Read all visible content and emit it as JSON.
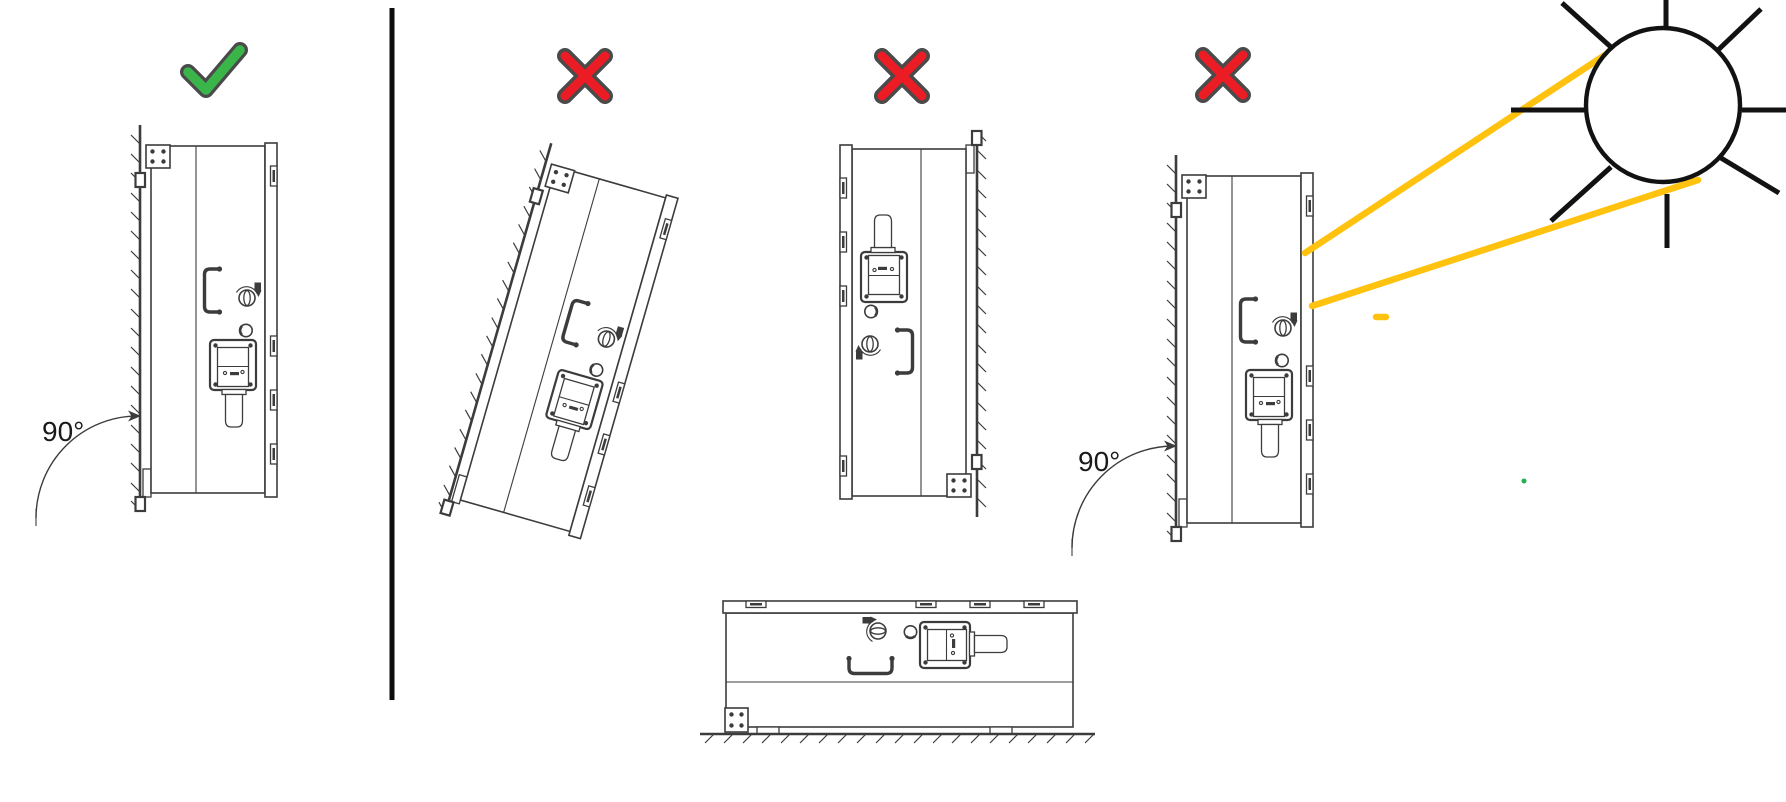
{
  "diagram": {
    "figures": [
      {
        "name": "correct-vertical-mount",
        "status": "correct",
        "status_icon": "checkmark-icon",
        "angle_label": "90°"
      },
      {
        "name": "tilted-mount",
        "status": "incorrect",
        "status_icon": "x-mark-icon"
      },
      {
        "name": "upside-down-mount",
        "status": "incorrect",
        "status_icon": "x-mark-icon"
      },
      {
        "name": "direct-sunlight-mount",
        "status": "incorrect",
        "status_icon": "x-mark-icon",
        "angle_label": "90°"
      },
      {
        "name": "horizontal-floor-mount",
        "status": "incorrect"
      }
    ],
    "icons": [
      "checkmark-icon",
      "x-mark-icon",
      "sun-icon"
    ],
    "colors": {
      "correct_green": "#3ab54a",
      "incorrect_red": "#ec1c24",
      "icon_outline": "#4a4a4a",
      "sunbeam_yellow": "#ffc20e",
      "sun_black": "#121212",
      "line_art": "#3c3c3c",
      "divider_black": "#0d0d0d",
      "stray_dot_green": "#22b14c"
    }
  }
}
